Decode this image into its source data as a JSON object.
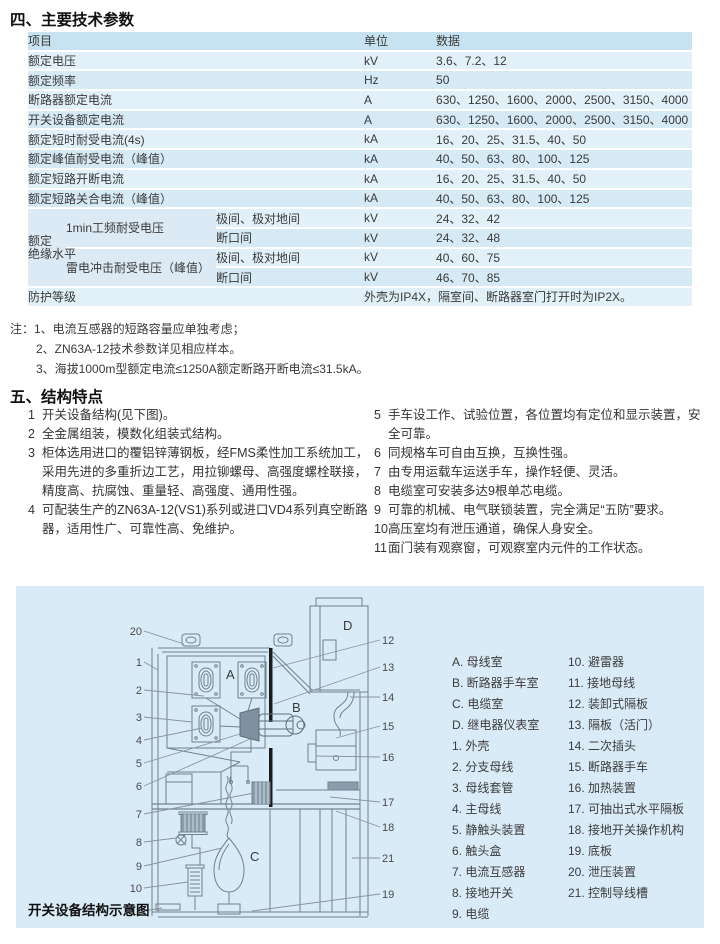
{
  "colors": {
    "panel_bg": "#d9ebf7",
    "table_header_bg": "#c7e2f0",
    "row_light": "#e1f0f9",
    "row_dark": "#d6eaf5",
    "text": "#3a3a3a",
    "diagram_line": "#70828e"
  },
  "section4": {
    "title": "四、主要技术参数",
    "table": {
      "headers": [
        "项目",
        "单位",
        "数据"
      ],
      "simple_rows": [
        {
          "label": "额定电压",
          "unit": "kV",
          "data": "3.6、7.2、12"
        },
        {
          "label": "额定频率",
          "unit": "Hz",
          "data": "50"
        },
        {
          "label": "断路器额定电流",
          "unit": "A",
          "data": "630、1250、1600、2000、2500、3150、4000"
        },
        {
          "label": "开关设备额定电流",
          "unit": "A",
          "data": "630、1250、1600、2000、2500、3150、4000"
        },
        {
          "label": "额定短时耐受电流(4s)",
          "unit": "kA",
          "data": "16、20、25、31.5、40、50"
        },
        {
          "label": "额定峰值耐受电流（峰值）",
          "unit": "kA",
          "data": "40、50、63、80、100、125"
        },
        {
          "label": "额定短路开断电流",
          "unit": "kA",
          "data": "16、20、25、31.5、40、50"
        },
        {
          "label": "额定短路关合电流（峰值）",
          "unit": "kA",
          "data": "40、50、63、80、100、125"
        }
      ],
      "insulation": {
        "group_label_line1": "额定",
        "group_label_line2": "绝缘水平",
        "tests": [
          {
            "name": "1min工频耐受电压",
            "rows": [
              {
                "scope": "极间、极对地间",
                "unit": "kV",
                "data": "24、32、42"
              },
              {
                "scope": "断口间",
                "unit": "kV",
                "data": "24、32、48"
              }
            ]
          },
          {
            "name": "雷电冲击耐受电压（峰值）",
            "rows": [
              {
                "scope": "极间、极对地间",
                "unit": "kV",
                "data": "40、60、75"
              },
              {
                "scope": "断口间",
                "unit": "kV",
                "data": "46、70、85"
              }
            ]
          }
        ]
      },
      "protection": {
        "label": "防护等级",
        "data": "外壳为IP4X，隔室间、断路器室门打开时为IP2X。"
      }
    },
    "notes": [
      "注：1、电流互感器的短路容量应单独考虑；",
      "2、ZN63A-12技术参数详见相应样本。",
      "3、海拔1000m型额定电流≤1250A额定断路开断电流≤31.5kA。"
    ]
  },
  "section5": {
    "title": "五、结构特点",
    "items_left": [
      {
        "num": "1",
        "text": "开关设备结构(见下图)。"
      },
      {
        "num": "2",
        "text": "全金属组装，模数化组装式结构。"
      },
      {
        "num": "3",
        "text": "柜体选用进口的覆铝锌薄钢板，经FMS柔性加工系统加工，采用先进的多重折边工艺，用拉铆螺母、高强度螺栓联接，精度高、抗腐蚀、重量轻、高强度、通用性强。"
      },
      {
        "num": "4",
        "text": "可配装生产的ZN63A-12(VS1)系列或进口VD4系列真空断路器，适用性广、可靠性高、免维护。"
      }
    ],
    "items_right": [
      {
        "num": "5",
        "text": "手车设工作、试验位置，各位置均有定位和显示装置，安全可靠。"
      },
      {
        "num": "6",
        "text": "同规格车可自由互换，互换性强。"
      },
      {
        "num": "7",
        "text": "由专用运载车运送手车，操作轻便、灵活。"
      },
      {
        "num": "8",
        "text": "电缆室可安装多达9根单芯电缆。"
      },
      {
        "num": "9",
        "text": "可靠的机械、电气联锁装置，完全满足“五防”要求。"
      },
      {
        "num": "10",
        "text": "高压室均有泄压通道，确保人身安全。"
      },
      {
        "num": "11",
        "text": "面门装有观察窗，可观察室内元件的工作状态。"
      }
    ]
  },
  "diagram": {
    "caption": "开关设备结构示意图",
    "compartments": [
      "A",
      "B",
      "C",
      "D"
    ],
    "labels_left": [
      "20",
      "1",
      "2",
      "3",
      "4",
      "5",
      "6",
      "7",
      "8",
      "9",
      "10",
      "11"
    ],
    "labels_right": [
      "12",
      "13",
      "14",
      "15",
      "16",
      "17",
      "18",
      "21",
      "19"
    ],
    "legend_col1": [
      "A. 母线室",
      "B. 断路器手车室",
      "C. 电缆室",
      "D. 继电器仪表室",
      "1. 外壳",
      "2. 分支母线",
      "3. 母线套管",
      "4. 主母线",
      "5. 静触头装置",
      "6. 触头盒",
      "7. 电流互感器",
      "8. 接地开关",
      "9. 电缆"
    ],
    "legend_col2": [
      "10. 避雷器",
      "11. 接地母线",
      "12. 装卸式隔板",
      "13. 隔板（活门）",
      "14. 二次插头",
      "15. 断路器手车",
      "16. 加热装置",
      "17. 可抽出式水平隔板",
      "18. 接地开关操作机构",
      "19. 底板",
      "20. 泄压装置",
      "21. 控制导线槽"
    ]
  }
}
